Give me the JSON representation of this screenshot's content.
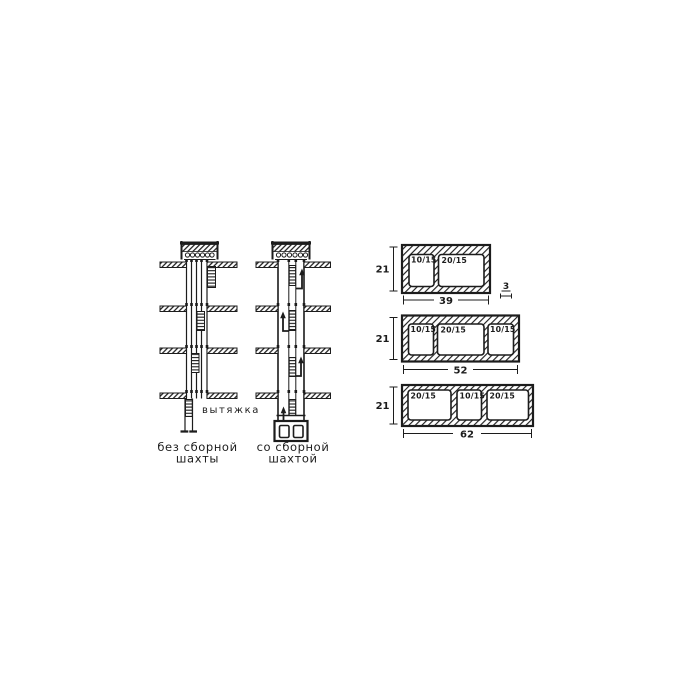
{
  "shafts": {
    "exhaust_label": "вытяжка",
    "captions": {
      "without": [
        "без сборной",
        "шахты"
      ],
      "with": [
        "со сборной",
        "шахтой"
      ]
    }
  },
  "blocks": [
    {
      "height": "21",
      "width": "39",
      "wall_thickness": "3",
      "openings": [
        "10/15",
        "20/15"
      ]
    },
    {
      "height": "21",
      "width": "52",
      "openings": [
        "10/15",
        "20/15",
        "10/15"
      ]
    },
    {
      "height": "21",
      "width": "62",
      "openings": [
        "20/15",
        "10/15",
        "20/15"
      ]
    }
  ],
  "colors": {
    "ink": "#1c1c1c",
    "paper": "#ffffff"
  }
}
